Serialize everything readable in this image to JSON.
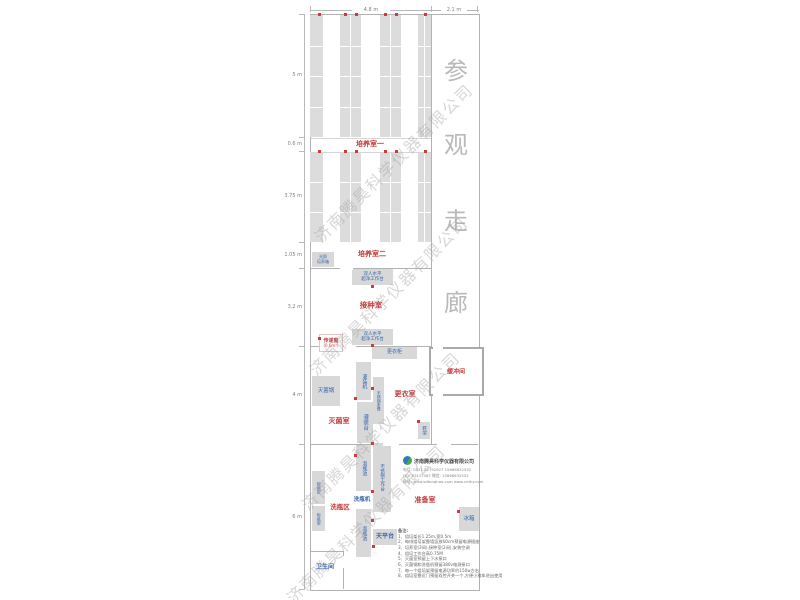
{
  "watermark": "济南腾昊科学仪器有限公司",
  "corridor": {
    "label": "参观走廊",
    "chars": [
      "参",
      "观",
      "走",
      "廊"
    ]
  },
  "dimensions": {
    "top": {
      "left_width": "4.8 m",
      "right_width": "2.1 m"
    },
    "left": [
      "5 m",
      "0.6 m",
      "3.75 m",
      "1.05 m",
      "3.2 m",
      "4 m",
      "6 m"
    ]
  },
  "rooms": {
    "culture1": "培养室一",
    "culture2": "培养室二",
    "inoculation": "接种室",
    "sterilization": "灭菌室",
    "changing": "更衣室",
    "buffer": "缓冲间",
    "washing_area": "洗瓶区",
    "prep": "准备室",
    "toilet": "卫生间",
    "pass_window": "传递窗",
    "pass_window_size": "(0.6m²)"
  },
  "equipment": {
    "light_incubator": {
      "line1": "光照",
      "line2": "培养箱"
    },
    "clean_bench": {
      "line1": "双人水平",
      "line2": "超净工作台"
    },
    "wardrobe": "更衣柜",
    "filling_machine": "灌装机",
    "steel_bench": "不锈钢条凳",
    "filling_table": "灌装台",
    "sterilizer": "灭菌锅",
    "shoe_rack": "鞋架",
    "soak_pool": "泡瓶池",
    "steel_worktable": "不锈钢工作台",
    "drying_rack": "晾瓶架",
    "bottle_washer": "洗瓶机",
    "balance_table": "天平台",
    "fridge": "冰箱"
  },
  "company": {
    "name": "济南腾昊科学仪器有限公司",
    "contact_lines": [
      "电话: 0531-82792827  15866632552",
      "QQ: 87437487  微信: 15866632552",
      "网址: www.sdtenghao.com  www.cnthy.com"
    ]
  },
  "notes": {
    "title": "备注:",
    "items": [
      "1、组培架长1.25m,宽0.5m",
      "2、每排组培架靠墙竖放60cm预留电源插座",
      "3、培养室(3间),接种室(2间),安装空调",
      "4、组培工作台高0.75M",
      "5、灭菌室预留上下水接口",
      "6、灭菌锅和洗瓶机预留380v电源接口",
      "7、每一个组培架预留电源功率约150w左右",
      "8、组培室靠近门预留双控开关一个,方便小推车进出使用"
    ]
  },
  "outlet_dots": [
    [
      318,
      13
    ],
    [
      344,
      13
    ],
    [
      355,
      13
    ],
    [
      384,
      13
    ],
    [
      395,
      13
    ],
    [
      424,
      13
    ],
    [
      318,
      150
    ],
    [
      344,
      150
    ],
    [
      355,
      150
    ],
    [
      384,
      150
    ],
    [
      395,
      150
    ],
    [
      424,
      150
    ],
    [
      371,
      285
    ],
    [
      371,
      344
    ],
    [
      318,
      337
    ],
    [
      371,
      387
    ],
    [
      354,
      397
    ],
    [
      417,
      420
    ],
    [
      371,
      442
    ],
    [
      354,
      454
    ],
    [
      371,
      490
    ],
    [
      371,
      519
    ],
    [
      372,
      545
    ],
    [
      457,
      510
    ]
  ],
  "colors": {
    "wall": "#b2b2b2",
    "rack_fill": "#dcdcdc",
    "equipment_fill": "#d8d8d8",
    "label_red": "#c43b3b",
    "label_blue": "#3566ad",
    "watermark_gray": "#a0a0a0"
  }
}
